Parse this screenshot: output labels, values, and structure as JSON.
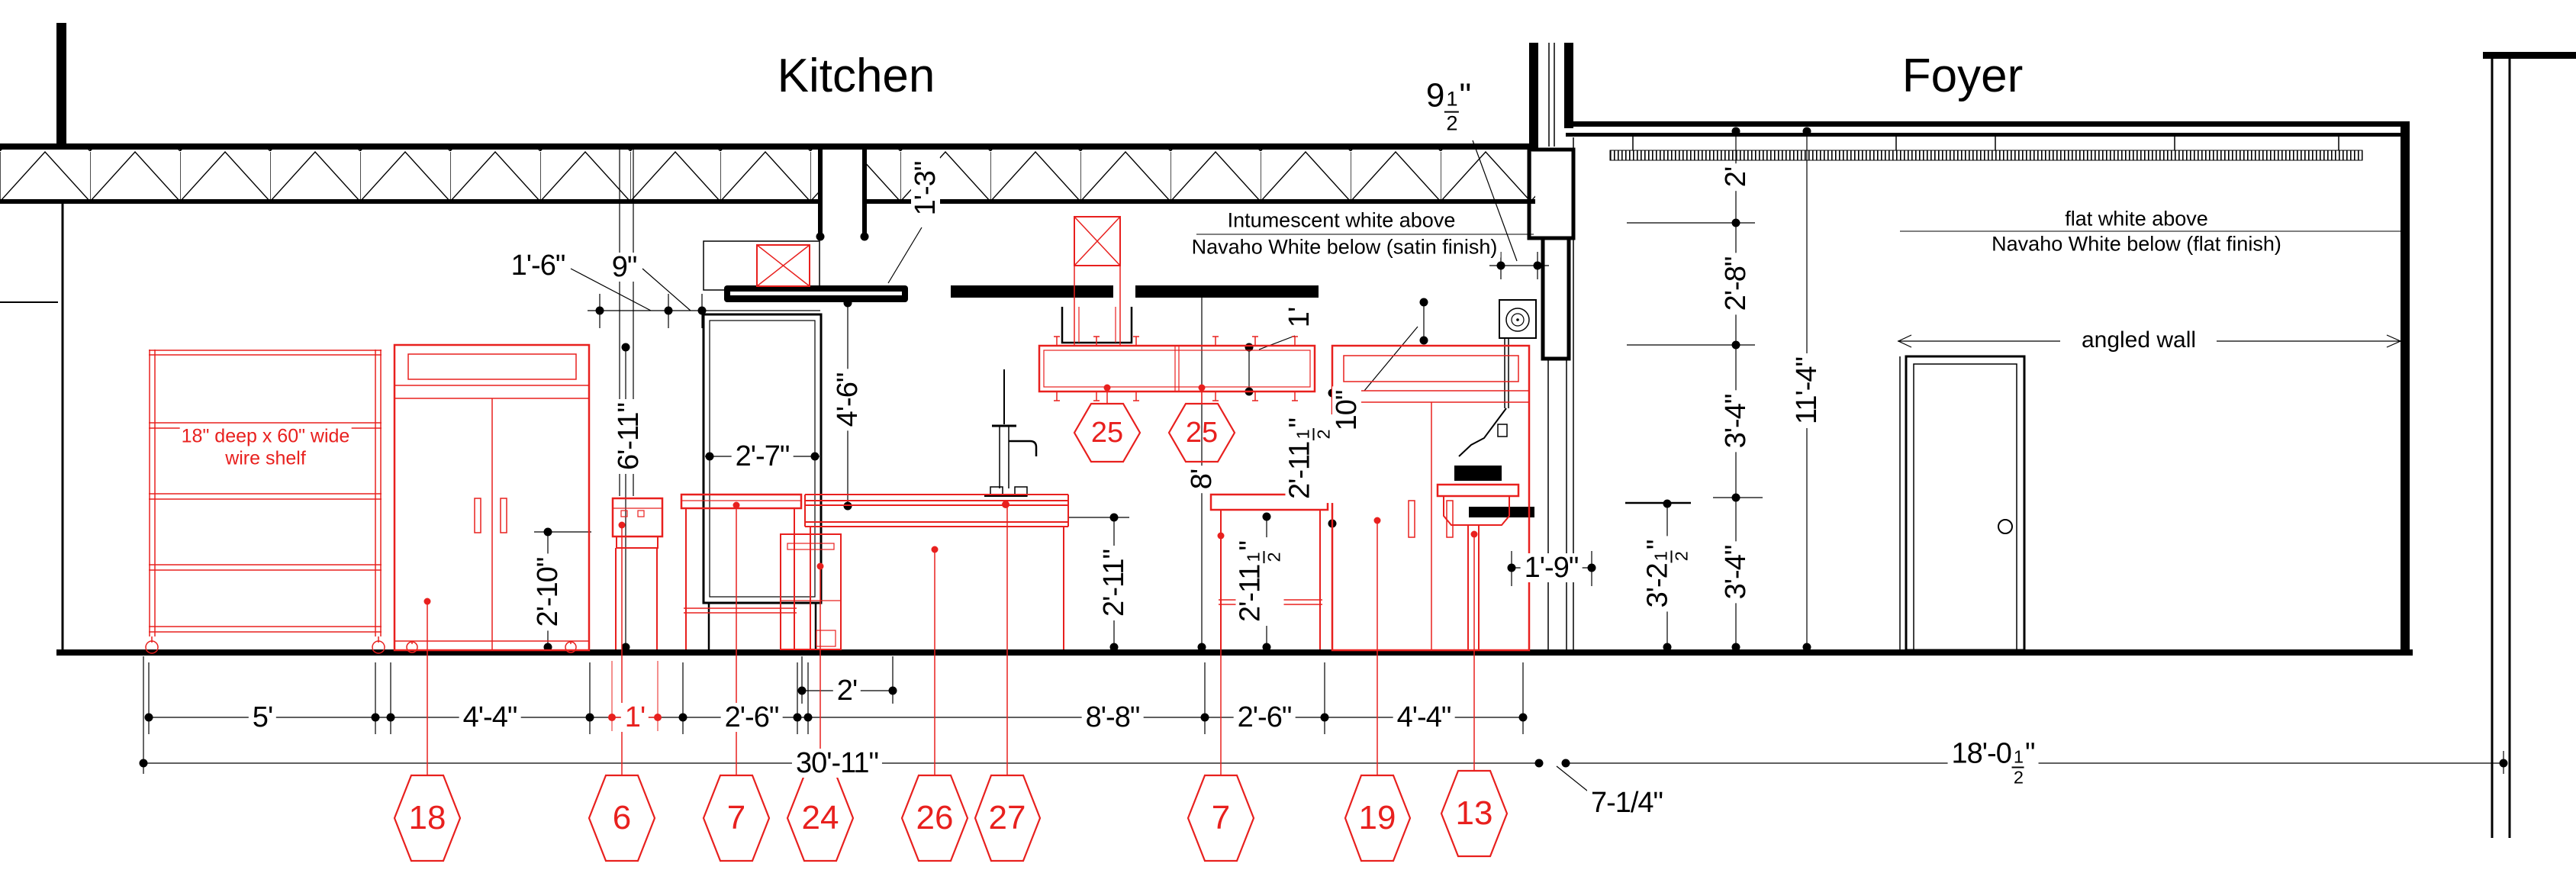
{
  "title": {
    "kitchen": "Kitchen",
    "foyer": "Foyer"
  },
  "notes": {
    "kitchen_above": "Intumescent white above",
    "kitchen_below": "Navaho White below (satin finish)",
    "foyer_above": "flat white above",
    "foyer_below": "Navaho White below (flat finish)",
    "angled_wall": "angled wall",
    "wire_shelf_1": "18\" deep x 60\" wide",
    "wire_shelf_2": "wire shelf"
  },
  "dims": {
    "v1_3": "1'-3\"",
    "v1_6": "1'-6\"",
    "v9": "9\"",
    "v2_7": "2'-7\"",
    "v4_6": "4'-6\"",
    "v6_11": "6'-11\"",
    "v2_10": "2'-10\"",
    "v1ft": "1'",
    "v10": "10\"",
    "v8ft": "8'",
    "v2_11": "2'-11\"",
    "v1_9": "1'-9\"",
    "b5": "5'",
    "b4_4": "4'-4\"",
    "b1": "1'",
    "b2_6": "2'-6\"",
    "b2": "2'",
    "b8_8": "8'-8\"",
    "b30_11": "30'-11\"",
    "b7_14": "7-1/4\"",
    "f2": "2'",
    "f2_8": "2'-8\"",
    "f3_4": "3'-4\"",
    "f11_4": "11'-4\""
  },
  "fracs": {
    "n9h": {
      "w": "9",
      "n": "1",
      "d": "2",
      "s": "\""
    },
    "n2_11h": {
      "w": "2'-11",
      "n": "1",
      "d": "2",
      "s": "\""
    },
    "n18h": {
      "w": "18'-0",
      "n": "1",
      "d": "2",
      "s": "\""
    },
    "n3_2h": {
      "w": "3'-2",
      "n": "1",
      "d": "2",
      "s": "\""
    }
  },
  "callouts": {
    "wire_shelf": "18",
    "range": "6",
    "work_table": "7",
    "dishwasher": "24",
    "counter": "26",
    "faucet": "27",
    "pot_rack": "25",
    "cabinet": "19",
    "hand_sink": "13"
  },
  "colors": {
    "new_work_red": "#e8201e",
    "ink": "#000000"
  }
}
